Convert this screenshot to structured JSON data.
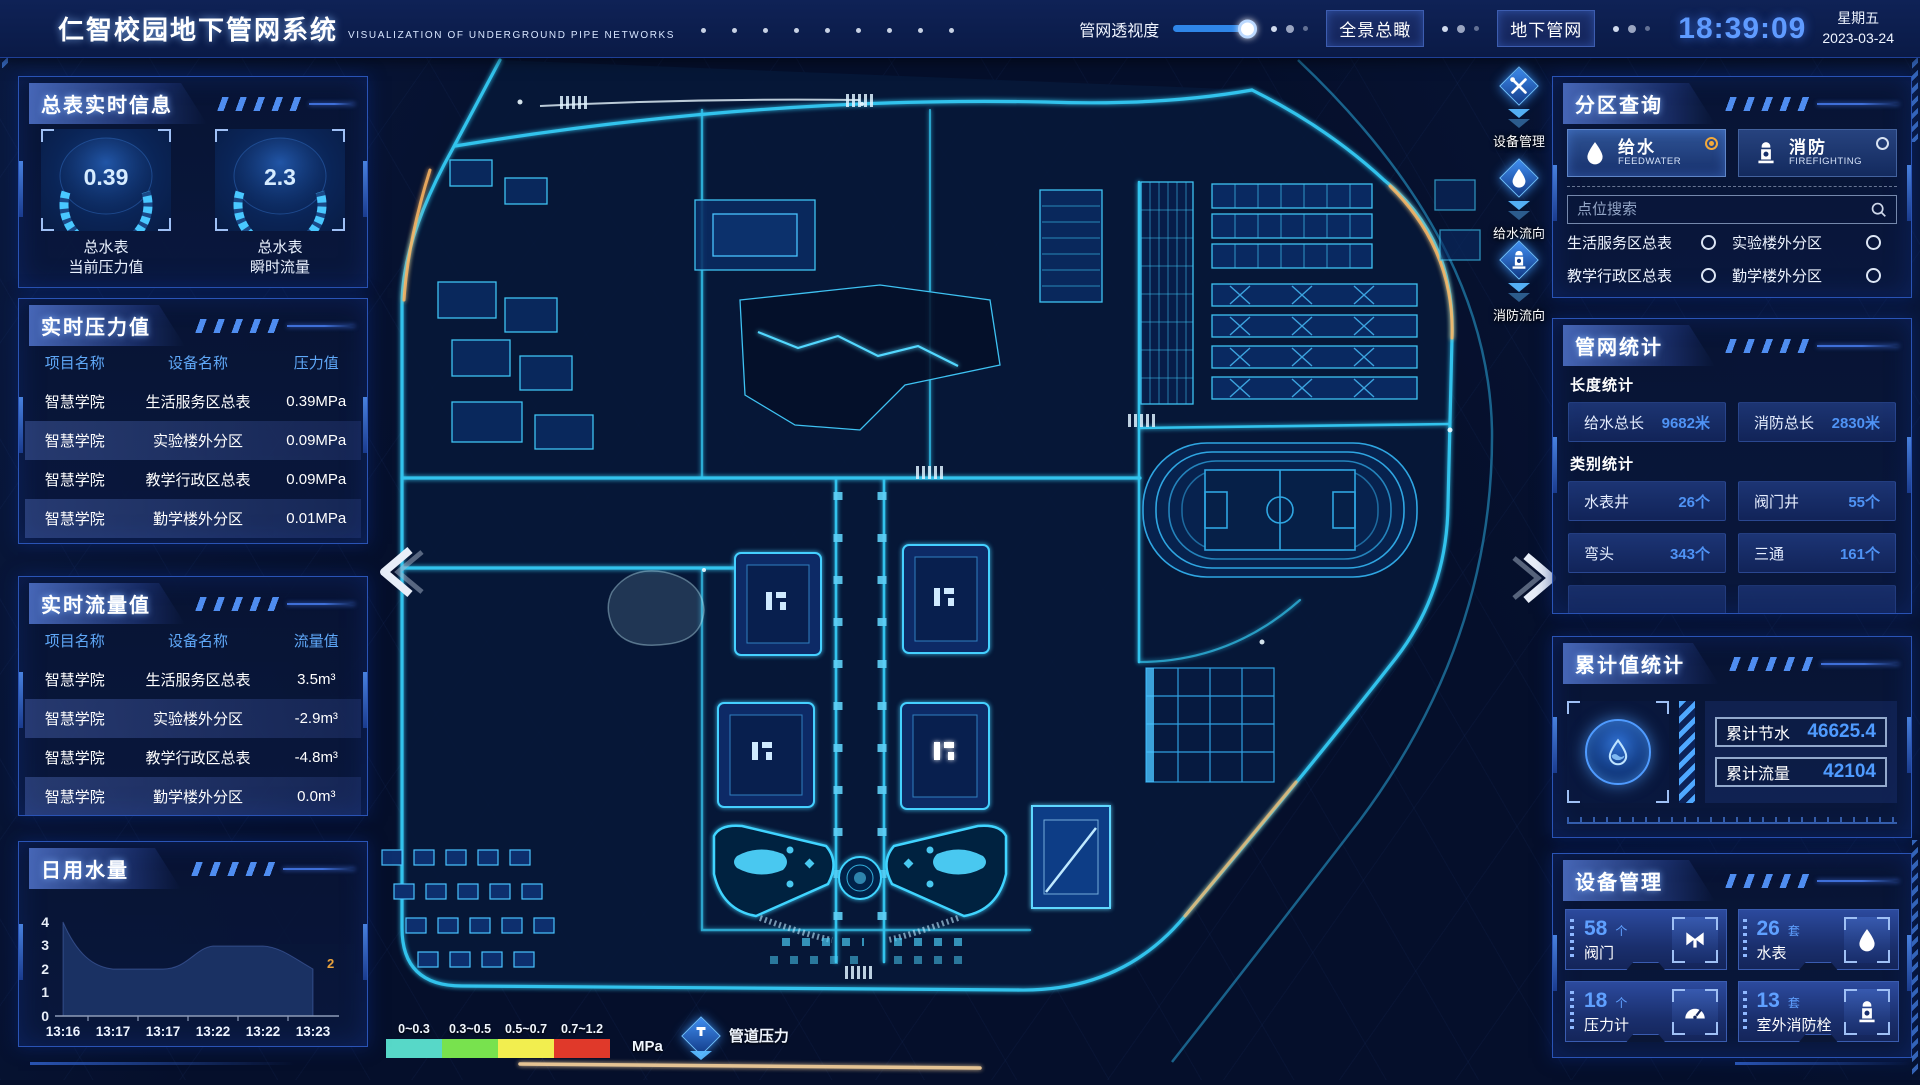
{
  "colors": {
    "accent_blue": "#3f8cff",
    "cyan_glow": "#35d4ff",
    "time_blue": "#5f9bff",
    "value_blue": "#4f93f5",
    "selected_radio_orange": "#f2a93b",
    "chart_label_orange": "#e8a23c",
    "legend_colors": [
      "#57d8c8",
      "#78e24e",
      "#f2ee4f",
      "#e0392a"
    ]
  },
  "header": {
    "title": "仁智校园地下管网系统",
    "subtitle": "VISUALIZATION OF UNDERGROUND PIPE NETWORKS",
    "transparency_label": "管网透视度",
    "overview_button": "全景总瞰",
    "underground_button": "地下管网",
    "time": "18:39:09",
    "weekday": "星期五",
    "date": "2023-03-24"
  },
  "left": {
    "master_meter": {
      "title": "总表实时信息",
      "gauges": [
        {
          "value": "0.39",
          "name": "总水表",
          "metric": "当前压力值"
        },
        {
          "value": "2.3",
          "name": "总水表",
          "metric": "瞬时流量"
        }
      ]
    },
    "pressure": {
      "title": "实时压力值",
      "headers": [
        "项目名称",
        "设备名称",
        "压力值"
      ],
      "rows": [
        {
          "project": "智慧学院",
          "device": "生活服务区总表",
          "value": "0.39MPa"
        },
        {
          "project": "智慧学院",
          "device": "实验楼外分区",
          "value": "0.09MPa"
        },
        {
          "project": "智慧学院",
          "device": "教学行政区总表",
          "value": "0.09MPa"
        },
        {
          "project": "智慧学院",
          "device": "勤学楼外分区",
          "value": "0.01MPa"
        },
        {
          "project": "智慧学院",
          "device": "砺学楼外分区",
          "value": "0.09MPa"
        }
      ]
    },
    "flow": {
      "title": "实时流量值",
      "headers": [
        "项目名称",
        "设备名称",
        "流量值"
      ],
      "rows": [
        {
          "project": "智慧学院",
          "device": "生活服务区总表",
          "value": "3.5m³"
        },
        {
          "project": "智慧学院",
          "device": "实验楼外分区",
          "value": "-2.9m³"
        },
        {
          "project": "智慧学院",
          "device": "教学行政区总表",
          "value": "-4.8m³"
        },
        {
          "project": "智慧学院",
          "device": "勤学楼外分区",
          "value": "0.0m³"
        },
        {
          "project": "智慧学院",
          "device": "砺学楼外分区",
          "value": "2.3m³"
        }
      ]
    },
    "daily_water": {
      "title": "日用水量",
      "chart_data": {
        "type": "area",
        "x": [
          "13:16",
          "13:17",
          "13:17",
          "13:22",
          "13:22",
          "13:23"
        ],
        "values": [
          4,
          2,
          2,
          3,
          3,
          2
        ],
        "y_ticks": [
          0,
          1,
          2,
          3,
          4
        ],
        "ylim": [
          0,
          4
        ],
        "grid": false,
        "legend_position": "none",
        "last_value_label": "2"
      }
    }
  },
  "map": {
    "float_icons": [
      {
        "icon": "tools-icon",
        "label": "设备管理"
      },
      {
        "icon": "water-drop-icon",
        "label": "给水流向"
      },
      {
        "icon": "hydrant-icon",
        "label": "消防流向"
      }
    ],
    "legend": {
      "ranges": [
        "0~0.3",
        "0.3~0.5",
        "0.5~0.7",
        "0.7~1.2"
      ],
      "unit": "MPa",
      "label": "管道压力"
    }
  },
  "right": {
    "zone_query": {
      "title": "分区查询",
      "tabs": [
        {
          "label": "给水",
          "sub": "FEEDWATER",
          "selected": true
        },
        {
          "label": "消防",
          "sub": "FIREFIGHTING",
          "selected": false
        }
      ],
      "search_placeholder": "点位搜索",
      "items": [
        "生活服务区总表",
        "实验楼外分区",
        "教学行政区总表",
        "勤学楼外分区",
        "砺学楼外分区",
        "宿舍区泵房"
      ]
    },
    "network_stats": {
      "title": "管网统计",
      "length_section": "长度统计",
      "length_stats": [
        {
          "label": "给水总长",
          "value": "9682米"
        },
        {
          "label": "消防总长",
          "value": "2830米"
        }
      ],
      "category_section": "类别统计",
      "category_stats": [
        {
          "label": "水表井",
          "value": "26个"
        },
        {
          "label": "阀门井",
          "value": "55个"
        },
        {
          "label": "弯头",
          "value": "343个"
        },
        {
          "label": "三通",
          "value": "161个"
        }
      ]
    },
    "cumulative": {
      "title": "累计值统计",
      "rows": [
        {
          "label": "累计节水",
          "value": "46625.4"
        },
        {
          "label": "累计流量",
          "value": "42104"
        }
      ]
    },
    "devices": {
      "title": "设备管理",
      "cards": [
        {
          "count": "58",
          "unit": "个",
          "label": "阀门",
          "icon": "valve-icon"
        },
        {
          "count": "26",
          "unit": "套",
          "label": "水表",
          "icon": "water-meter-icon"
        },
        {
          "count": "18",
          "unit": "个",
          "label": "压力计",
          "icon": "pressure-gauge-icon"
        },
        {
          "count": "13",
          "unit": "套",
          "label": "室外消防栓",
          "icon": "outdoor-hydrant-icon"
        }
      ]
    }
  }
}
